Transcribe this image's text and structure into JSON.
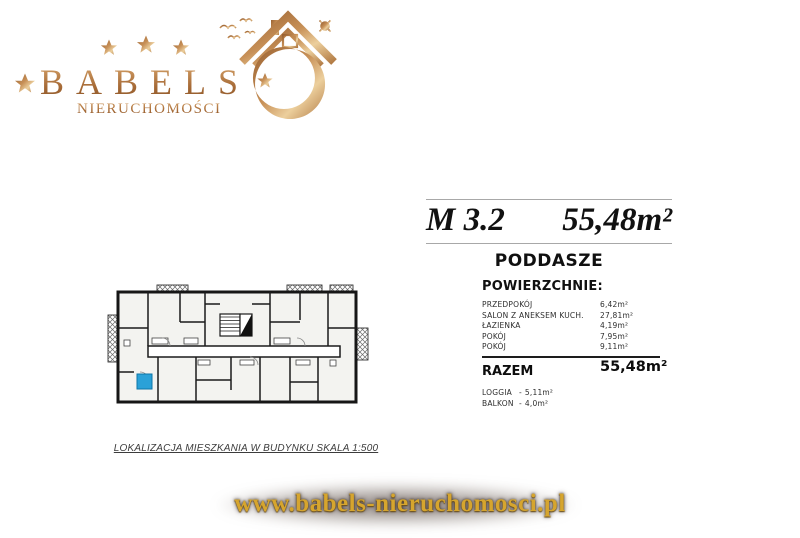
{
  "brand": {
    "name": "BABELS",
    "subtitle": "NIERUCHOMOŚCI",
    "colors": {
      "gold_dark": "#9a6232",
      "gold_mid": "#c79057",
      "gold_light": "#eccf9d"
    }
  },
  "listing": {
    "unit": "M 3.2",
    "total_area": "55,48m²",
    "floor": "PODDASZE",
    "areas_header": "POWIERZCHNIE:",
    "rooms": [
      {
        "label": "PRZEDPOKÓJ",
        "value": "6,42m²"
      },
      {
        "label": "SALON Z ANEKSEM KUCH.",
        "value": "27,81m²"
      },
      {
        "label": "ŁAZIENKA",
        "value": "4,19m²"
      },
      {
        "label": "POKÓJ",
        "value": "7,95m²"
      },
      {
        "label": "POKÓJ",
        "value": "9,11m²"
      }
    ],
    "total_label": "RAZEM",
    "total_value": "55,48m²",
    "extras": [
      {
        "label": "LOGGIA",
        "sep": "-",
        "value": "5,11m²"
      },
      {
        "label": "BALKON",
        "sep": "-",
        "value": "4,0m²"
      }
    ]
  },
  "plan": {
    "caption": "LOKALIZACJA MIESZKANIA W BUDYNKU SKALA 1:500",
    "marker_color": "#2aa1d8",
    "wall_color": "#1a1a1a",
    "fill_color": "#f3f3f0"
  },
  "footer": {
    "url": "www.babels-nieruchomosci.pl"
  }
}
